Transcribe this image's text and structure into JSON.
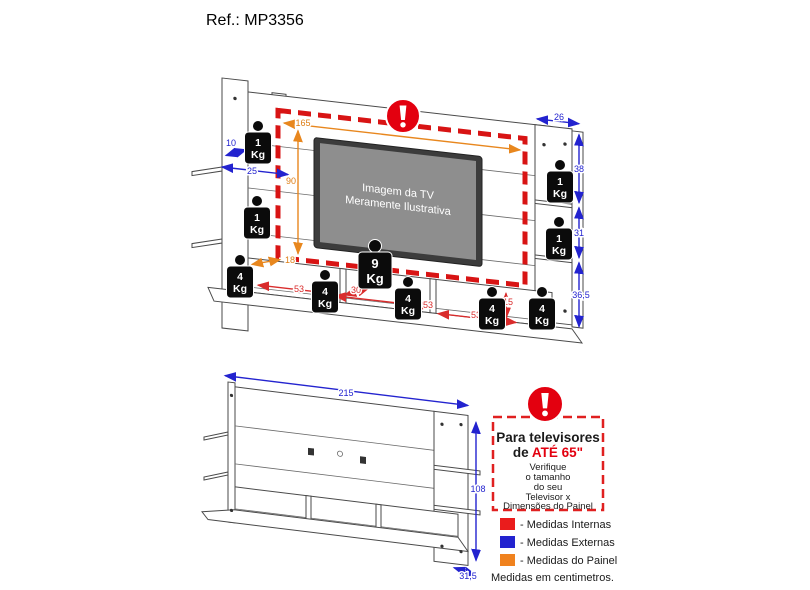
{
  "page": {
    "title": "Ref.: MP3356"
  },
  "colors": {
    "internal_red": "#ea1c1c",
    "external_blue": "#2323cf",
    "panel_orange": "#f0821e",
    "warning_red": "#e3000f",
    "dash_red": "#d81414"
  },
  "main_diagram": {
    "tv_label_line1": "Imagem da TV",
    "tv_label_line2": "Meramente Ilustrativa",
    "warning_icon": "exclamation",
    "dims_panel": {
      "width": "165",
      "height": "90",
      "base_depth": "18"
    },
    "dims_external": {
      "shelf_depth": "10",
      "shelf_width": "25",
      "column_width": "26",
      "column_seg_top": "38",
      "column_seg_mid": "31",
      "column_seg_bottom": "36,5"
    },
    "dims_internal": {
      "cubby1_width": "53",
      "cubby_depth": "30",
      "cubby2_width": "53",
      "cubby3_width": "53",
      "cubby_height": "15"
    },
    "weights": [
      {
        "value": "1",
        "unit": "Kg"
      },
      {
        "value": "1",
        "unit": "Kg"
      },
      {
        "value": "1",
        "unit": "Kg"
      },
      {
        "value": "1",
        "unit": "Kg"
      },
      {
        "value": "4",
        "unit": "Kg"
      },
      {
        "value": "4",
        "unit": "Kg"
      },
      {
        "value": "9",
        "unit": "Kg"
      },
      {
        "value": "4",
        "unit": "Kg"
      },
      {
        "value": "4",
        "unit": "Kg"
      },
      {
        "value": "4",
        "unit": "Kg"
      }
    ]
  },
  "bottom_diagram": {
    "dims": {
      "width": "215",
      "height": "108",
      "depth": "31,5"
    }
  },
  "notice_box": {
    "line1": "Para televisores",
    "line2_prefix": "de ",
    "line2_highlight": "ATÉ 65\"",
    "note_lines": [
      "Verifique",
      "o tamanho",
      "do seu",
      "Televisor x",
      "Dimensões do Painel"
    ]
  },
  "legend": {
    "items": [
      {
        "color": "#ea1c1c",
        "label": "- Medidas Internas"
      },
      {
        "color": "#2323cf",
        "label": "- Medidas Externas"
      },
      {
        "color": "#f0821e",
        "label": "- Medidas do Painel"
      }
    ],
    "footnote": "Medidas em centimetros."
  }
}
